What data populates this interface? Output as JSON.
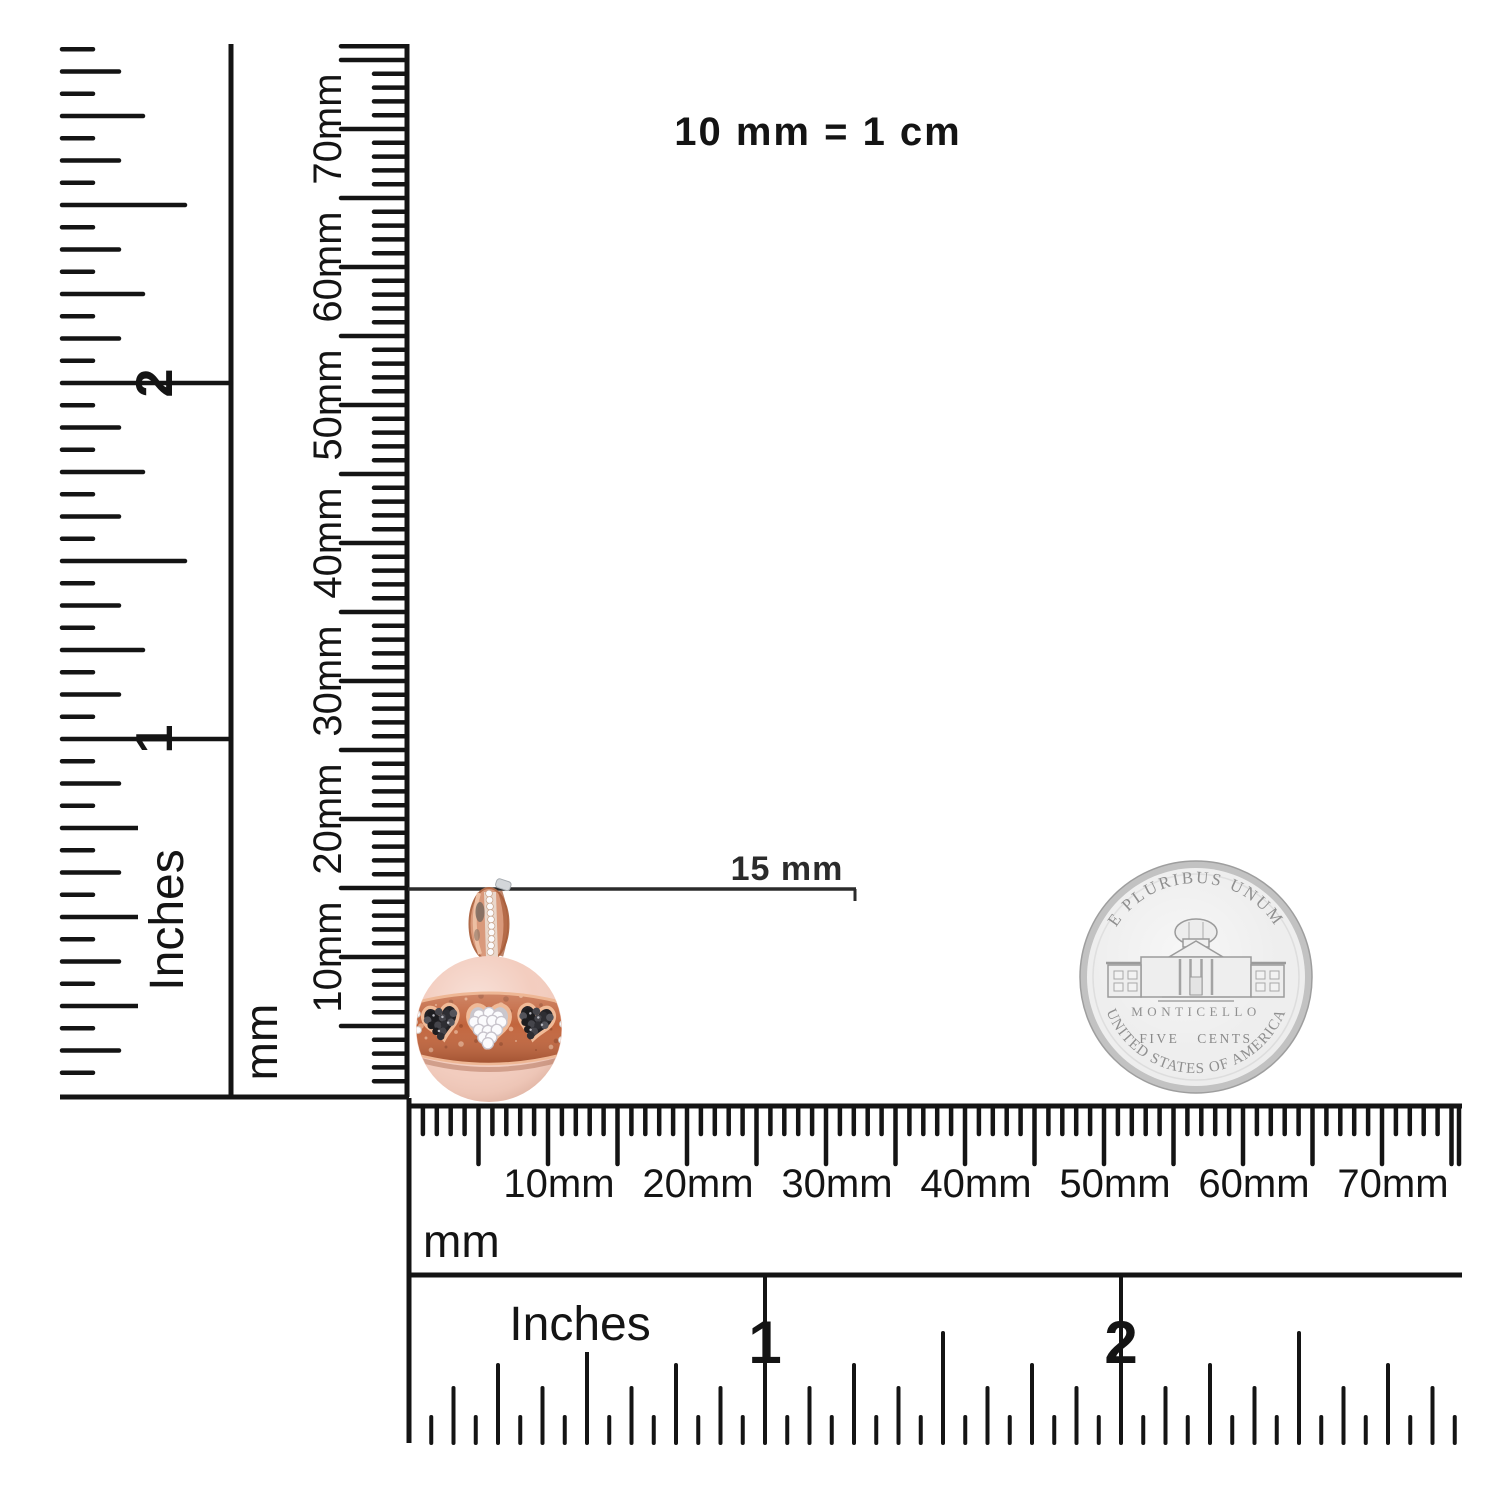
{
  "scale_note": "10 mm = 1 cm",
  "measurement": {
    "label": "15 mm"
  },
  "rulers": {
    "vertical_mm": {
      "unit_label": "mm",
      "tick_labels": [
        "10mm",
        "20mm",
        "30mm",
        "40mm",
        "50mm",
        "60mm",
        "70mm"
      ]
    },
    "vertical_inch": {
      "unit_label": "Inches",
      "tick_labels": [
        "1",
        "2"
      ]
    },
    "horizontal_mm": {
      "unit_label": "mm",
      "tick_labels": [
        "10mm",
        "20mm",
        "30mm",
        "40mm",
        "50mm",
        "60mm",
        "70mm"
      ]
    },
    "horizontal_inch": {
      "unit_label": "Inches",
      "tick_labels": [
        "1",
        "2"
      ]
    }
  },
  "coin": {
    "top_legend": "E PLURIBUS UNUM",
    "building_label": "MONTICELLO",
    "denomination": "FIVE CENTS",
    "bottom_legend": "UNITED STATES OF AMERICA",
    "colors": {
      "edge": "#c2c2c2",
      "face": "#ededed",
      "engraving": "#8f8f8f"
    }
  },
  "pendant": {
    "alt": "Rose gold ball charm with black and white diamond pave hearts",
    "colors": {
      "ball": "#f3cdbf",
      "band": "#c2653d",
      "band_rim": "#eeb795",
      "black_pave": "#232226",
      "white_pave": "#cac7cd",
      "stone_white": "#fbfbfd",
      "bail": "#d9997b",
      "bail_dark": "#b06a48"
    }
  },
  "ink": "#141414"
}
